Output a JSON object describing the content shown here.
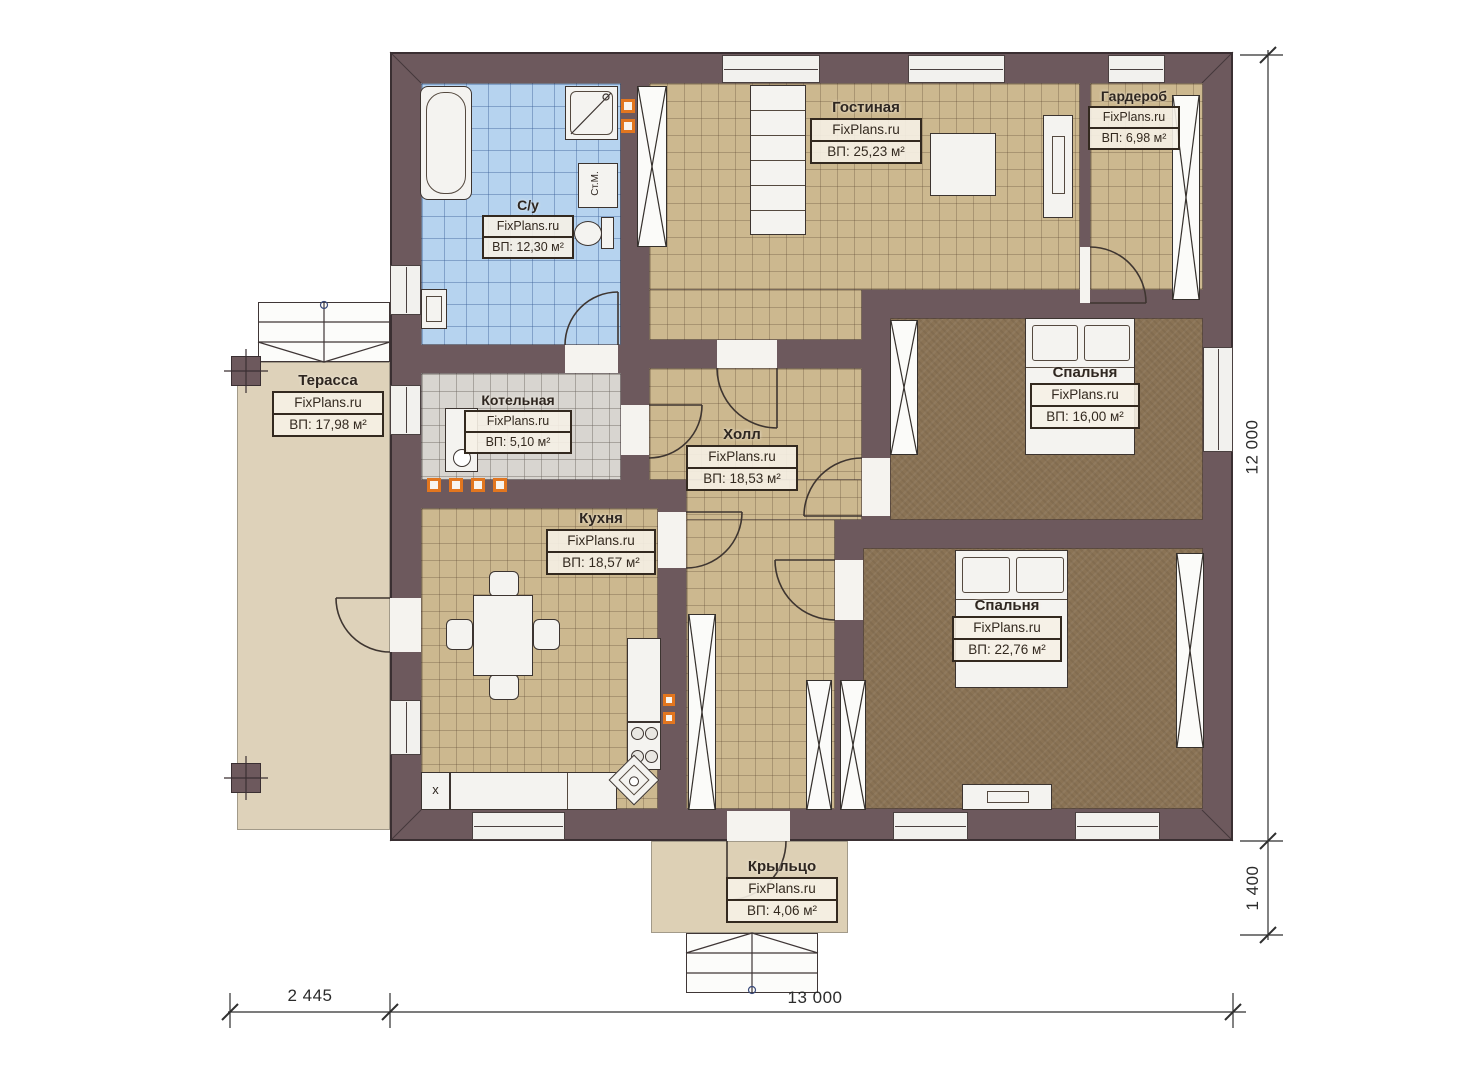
{
  "plan": {
    "rooms": [
      {
        "name": "С/у",
        "brand": "FixPlans.ru",
        "area": "ВП: 12,30 м²"
      },
      {
        "name": "Гостиная",
        "brand": "FixPlans.ru",
        "area": "ВП: 25,23 м²"
      },
      {
        "name": "Гардероб",
        "brand": "FixPlans.ru",
        "area": "ВП: 6,98 м²"
      },
      {
        "name": "Терасса",
        "brand": "FixPlans.ru",
        "area": "ВП: 17,98 м²"
      },
      {
        "name": "Котельная",
        "brand": "FixPlans.ru",
        "area": "ВП: 5,10 м²"
      },
      {
        "name": "Холл",
        "brand": "FixPlans.ru",
        "area": "ВП: 18,53 м²"
      },
      {
        "name": "Кухня",
        "brand": "FixPlans.ru",
        "area": "ВП: 18,57 м²"
      },
      {
        "name": "Спальня",
        "brand": "FixPlans.ru",
        "area": "ВП: 16,00 м²"
      },
      {
        "name": "Спальня",
        "brand": "FixPlans.ru",
        "area": "ВП: 22,76 м²"
      },
      {
        "name": "Крыльцо",
        "brand": "FixPlans.ru",
        "area": "ВП: 4,06 м²"
      }
    ],
    "dimensions": {
      "bottom_left": "2 445",
      "bottom_main": "13 000",
      "right_main": "12 000",
      "right_porch": "1 400"
    },
    "fixtures": {
      "washing_machine": "Ст.М.",
      "kitchen_unit_mark": "x"
    },
    "colors": {
      "wall": "#6d595d",
      "floor_tile": "#ccb88f",
      "bath_tile": "#b6d3ef",
      "boiler_tile": "#d8d5d0",
      "bedroom_floor": "#8a7355",
      "terrace": "#ded2ba",
      "accent_marker": "#e2761f"
    }
  }
}
